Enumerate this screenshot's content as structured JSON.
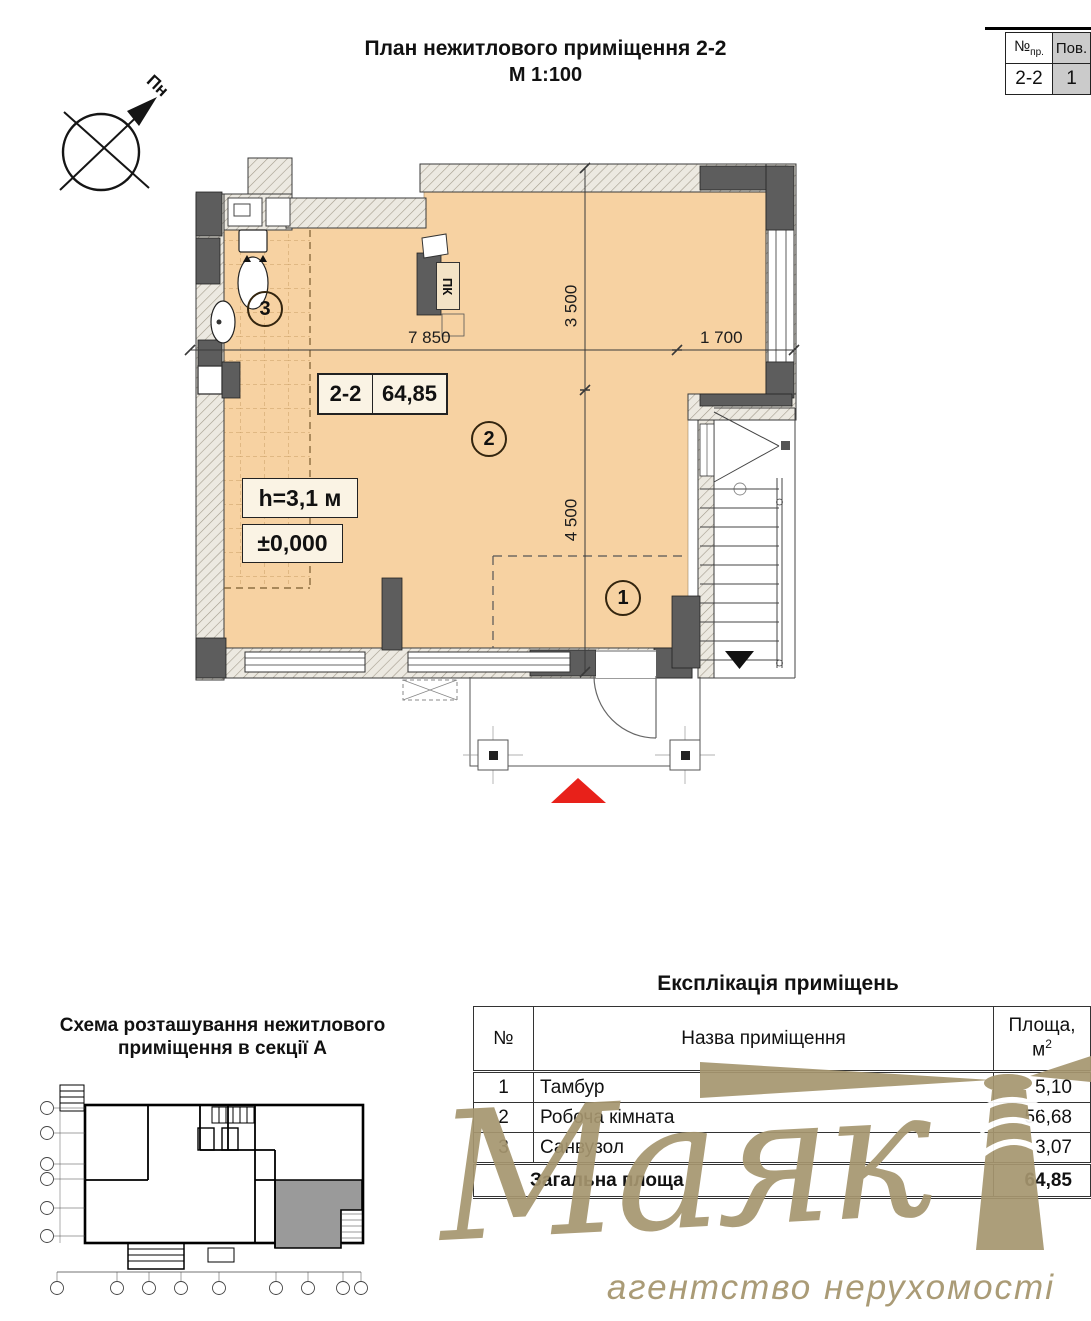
{
  "header": {
    "title_line1": "План нежитлового приміщення 2-2",
    "title_line2": "М 1:100",
    "corner_table": {
      "col1_header_main": "№",
      "col1_header_sub": "пр.",
      "col2_header": "Пов.",
      "col1_value": "2-2",
      "col2_value": "1"
    }
  },
  "compass": {
    "north_label": "Пн"
  },
  "plan": {
    "unit_box": {
      "unit_number": "2-2",
      "area": "64,85"
    },
    "height_label": "h=3,1 м",
    "level_label": "±0,000",
    "pk_label": "ПК",
    "room_markers": {
      "room1": "1",
      "room2": "2",
      "room3": "3"
    },
    "dimensions": {
      "top_width": "7 850",
      "top_right_width": "1 700",
      "upper_height": "3 500",
      "lower_height": "4 500"
    }
  },
  "scheme": {
    "title_line1": "Схема розташування нежитлового",
    "title_line2": "приміщення в секції А"
  },
  "explication": {
    "title": "Експлікація приміщень",
    "headers": {
      "no": "№",
      "name": "Назва приміщення",
      "area_line1": "Площа,",
      "area_base": "м",
      "area_sup": "2"
    },
    "rows": [
      {
        "no": "1",
        "name": "Тамбур",
        "area": "5,10"
      },
      {
        "no": "2",
        "name": "Робоча кімната",
        "area": "56,68"
      },
      {
        "no": "3",
        "name": "Санвузол",
        "area": "3,07"
      }
    ],
    "total": {
      "label": "Загальна площа",
      "area": "64,85"
    }
  },
  "watermark": {
    "brand": "Маяк",
    "tagline": "агентство нерухомості"
  },
  "colors": {
    "floor": "#f7d2a2",
    "wall_dark": "#5d5d5d",
    "watermark": "#a6966f",
    "entrance_marker": "#e8211a",
    "corner_cell_gray": "#cbcbcb"
  }
}
